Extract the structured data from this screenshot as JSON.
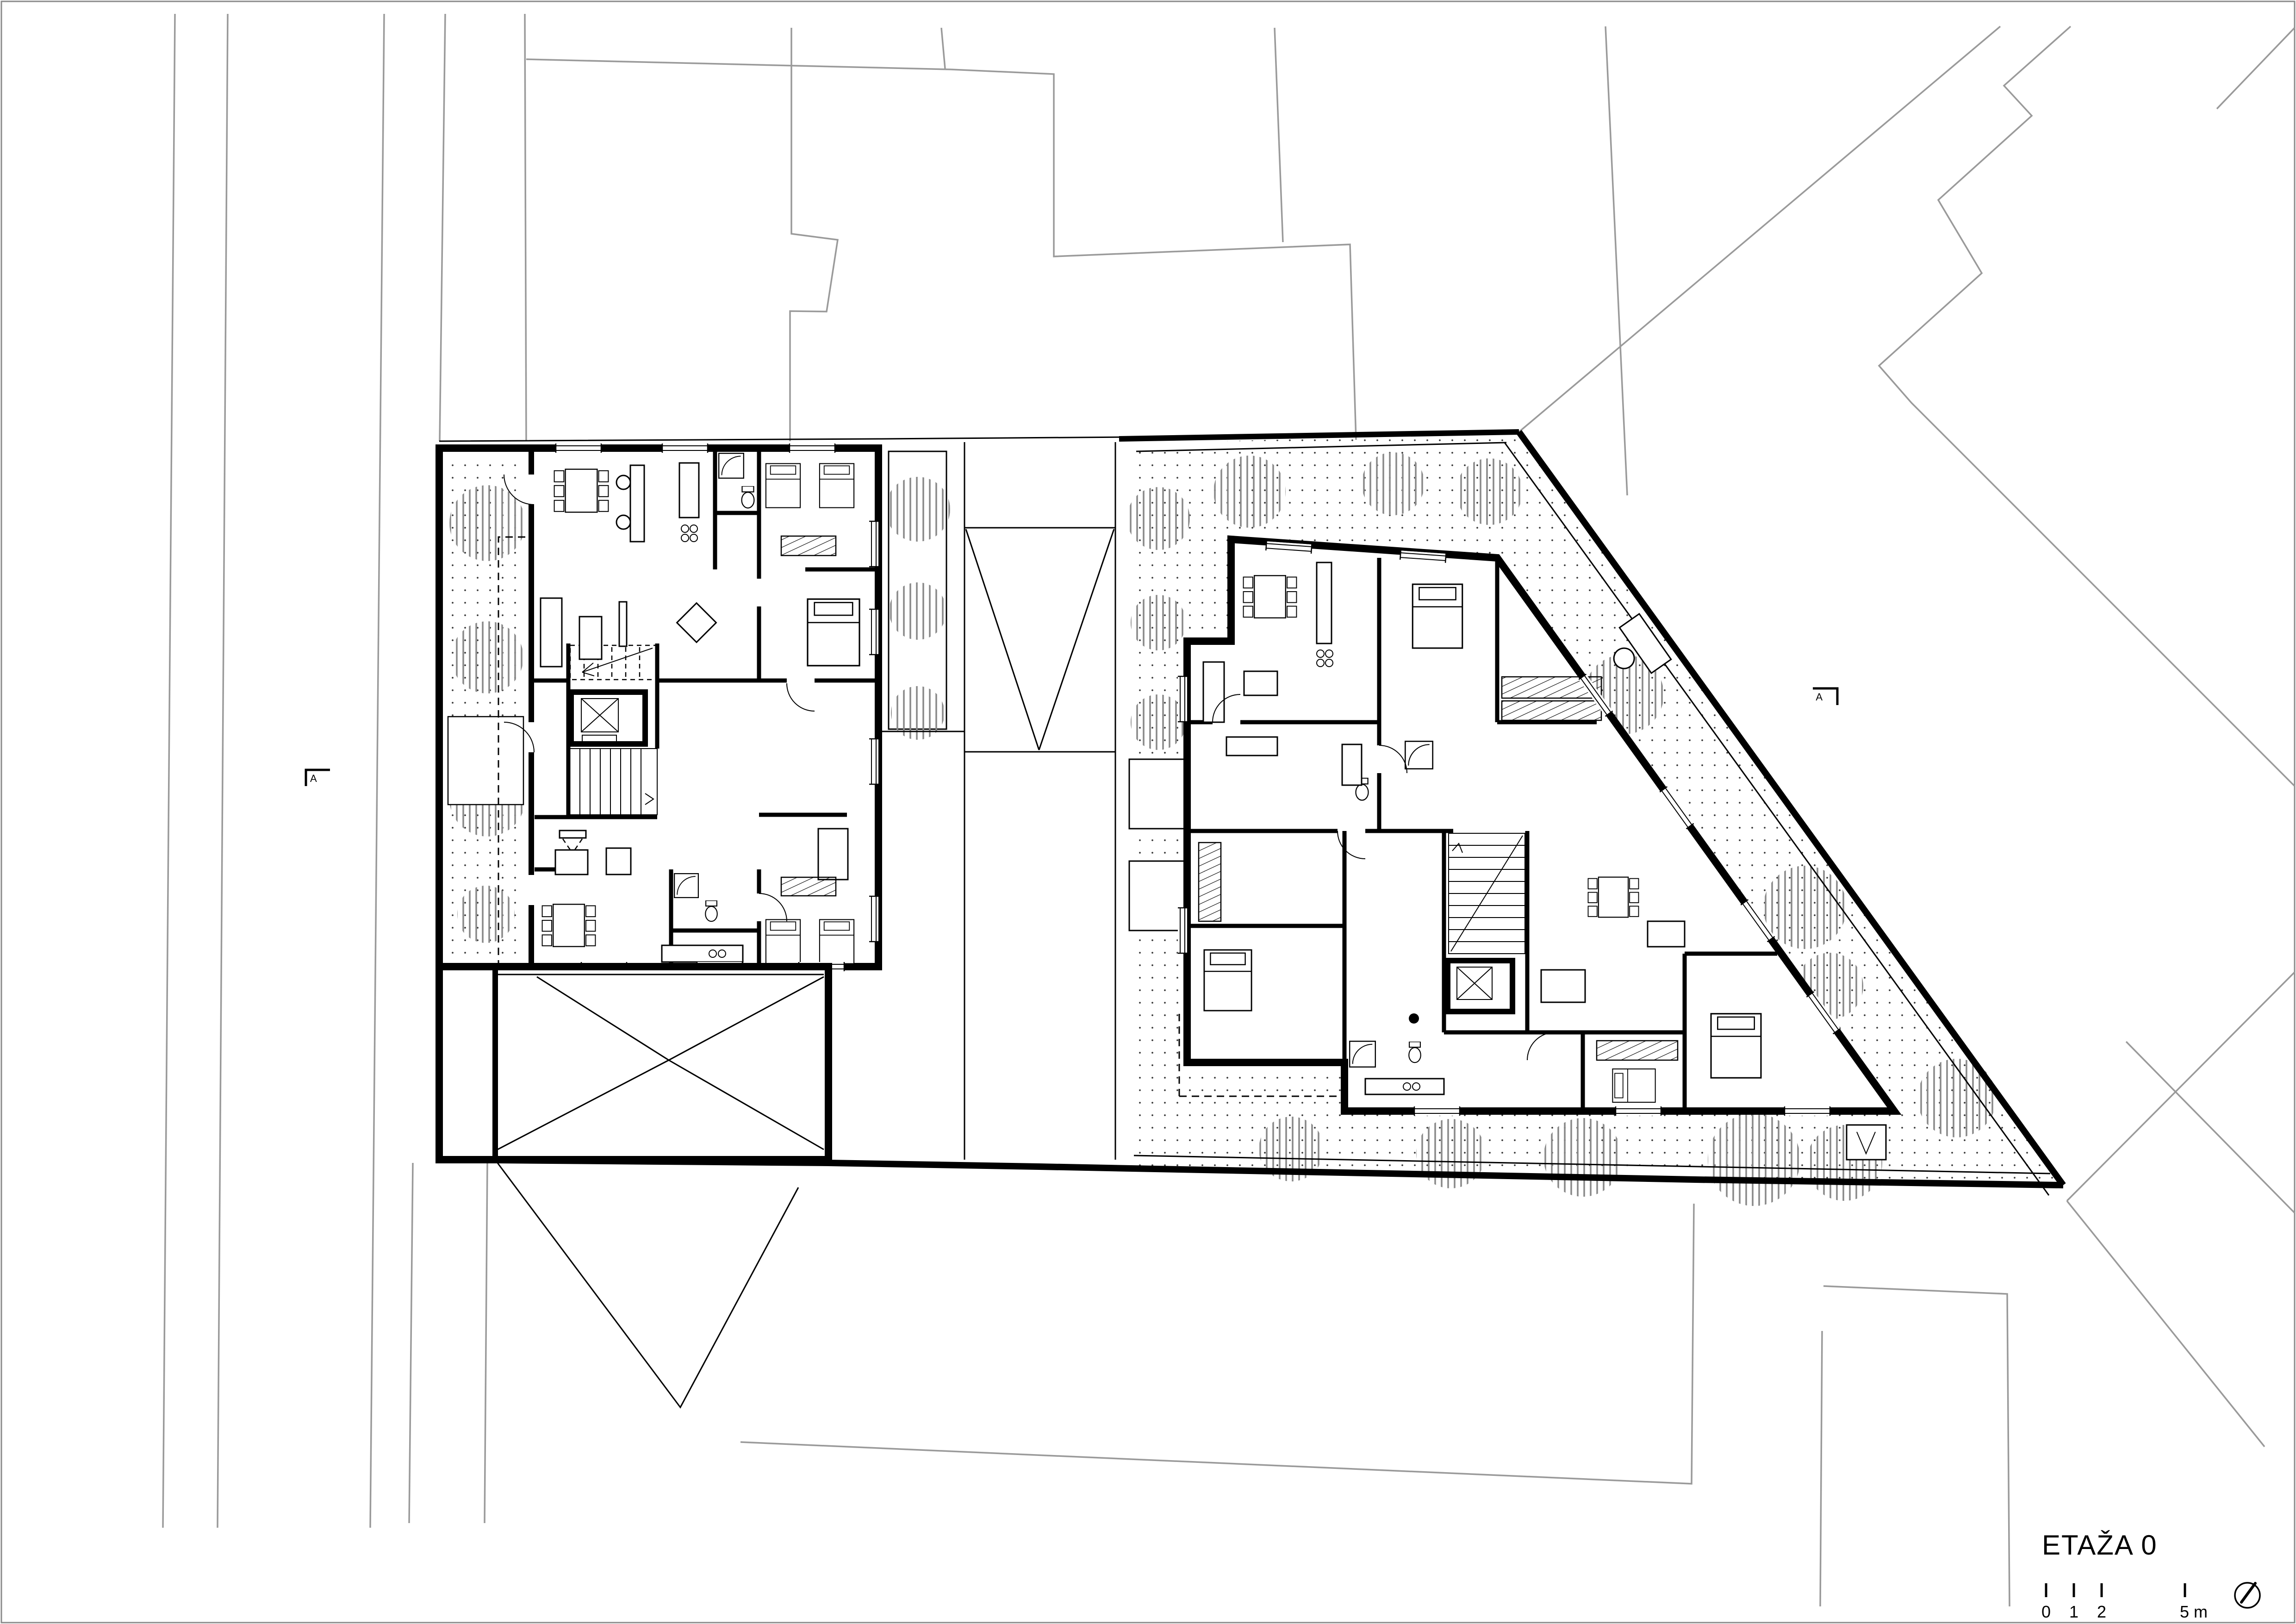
{
  "title": {
    "text": "ETAŽA 0"
  },
  "scale_bar": {
    "tick_labels": [
      "0",
      "1",
      "2"
    ],
    "end_label": "5 m"
  },
  "section_markers": {
    "left": {
      "label": "A"
    },
    "right": {
      "label": "A"
    }
  },
  "icons": {
    "north_arrow": "north-arrow-compass-circle"
  },
  "colors": {
    "ink": "#000000",
    "parcel_line": "#9a9a9a",
    "tree_hatch": "#8a8a8a",
    "ground_dot": "#3a3a3a",
    "paper": "#ffffff"
  }
}
